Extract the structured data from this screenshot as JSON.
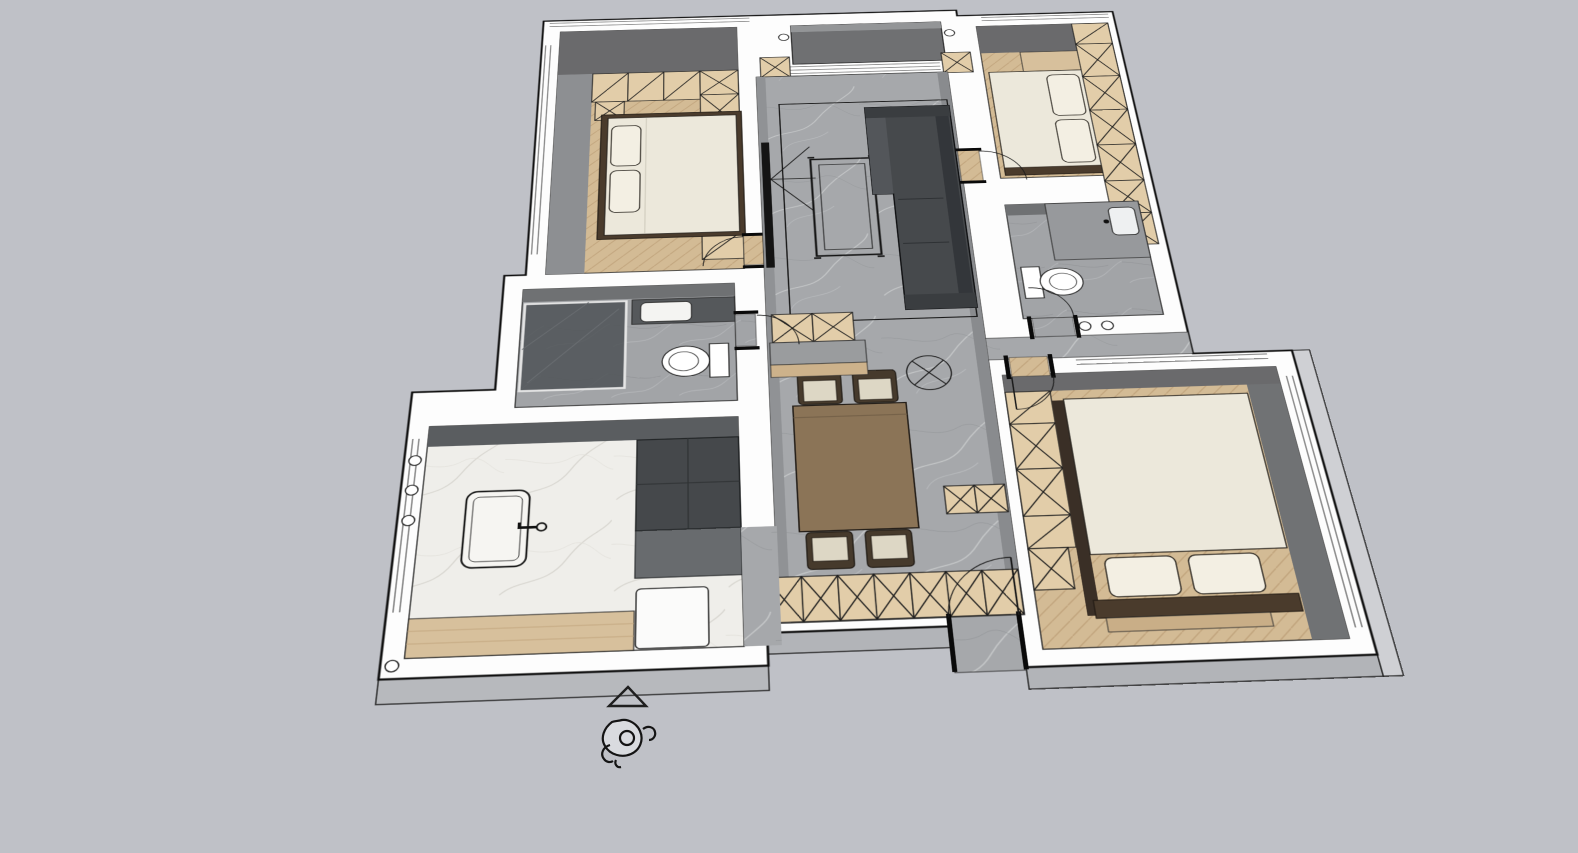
{
  "view": {
    "kind": "3d-floor-plan-render",
    "style": "sketchup-like-viewport",
    "background": "#bfc1c7"
  },
  "palette": {
    "wall": "#fdfdfd",
    "outline": "#141414",
    "wallFaceDark": "#6a6a6c",
    "wallFaceMid": "#8d8f92",
    "wallFaceLight": "#b7b9bd",
    "marble": "#a6a8ab",
    "whiteMarble": "#efeeea",
    "wood": "#d7c09c",
    "cabinet": "#e2cda9",
    "balcony": "#6f7072",
    "tile": "#a2a4a7",
    "linen": "#ece8db",
    "pillow": "#f3efe3",
    "sofa": "#46494c",
    "sofaBack": "#33363a",
    "diningTable": "#8b7457",
    "chairFrame": "#463a2c",
    "chairSeat": "#ddd7c5",
    "darkUnit": "#45484b",
    "bedFrame": "#4a3b2c",
    "glass": "#4e5256"
  },
  "rooms": [
    {
      "id": "bedroom-top-left",
      "floor": "wood-herringbone",
      "furniture": [
        "double-bed",
        "wardrobe-x-modules",
        "overhead-cabinets",
        "nightstand"
      ]
    },
    {
      "id": "balcony",
      "floor": "dark-gray-deck",
      "furniture": [
        "side-cabinets"
      ]
    },
    {
      "id": "living-room",
      "floor": "gray-marble",
      "furniture": [
        "sofa-with-chaise",
        "coffee-table",
        "tv-panel",
        "rug-outline",
        "ceiling-fan-symbol"
      ]
    },
    {
      "id": "dining-area",
      "floor": "gray-marble",
      "furniture": [
        "dining-table",
        "four-chairs",
        "sideboard-x-cabinet-row"
      ]
    },
    {
      "id": "bedroom-top-right",
      "floor": "wood-herringbone",
      "furniture": [
        "double-bed",
        "tall-wardrobe-x-column",
        "headboard-cabinet"
      ]
    },
    {
      "id": "bathroom-left",
      "floor": "gray-tile",
      "furniture": [
        "glass-shower",
        "toilet",
        "vanity-sink"
      ]
    },
    {
      "id": "bathroom-right",
      "floor": "gray-tile",
      "furniture": [
        "toilet",
        "vanity-counter",
        "sink"
      ]
    },
    {
      "id": "kitchen",
      "floor": "white-marble",
      "furniture": [
        "sink-with-faucet",
        "tall-dark-units",
        "wood-plank-strip",
        "appliance-box"
      ]
    },
    {
      "id": "bedroom-bottom-right",
      "floor": "wood-herringbone",
      "furniture": [
        "double-bed",
        "wardrobe-x-modules",
        "foot-bench"
      ]
    },
    {
      "id": "entry-hall",
      "floor": "gray-marble",
      "furniture": [
        "shoe-cabinet-x-modules",
        "door-swing-arc"
      ]
    }
  ],
  "markers": {
    "direction_triangle": "outlined-triangle",
    "scale_figure": "person-top-view"
  }
}
